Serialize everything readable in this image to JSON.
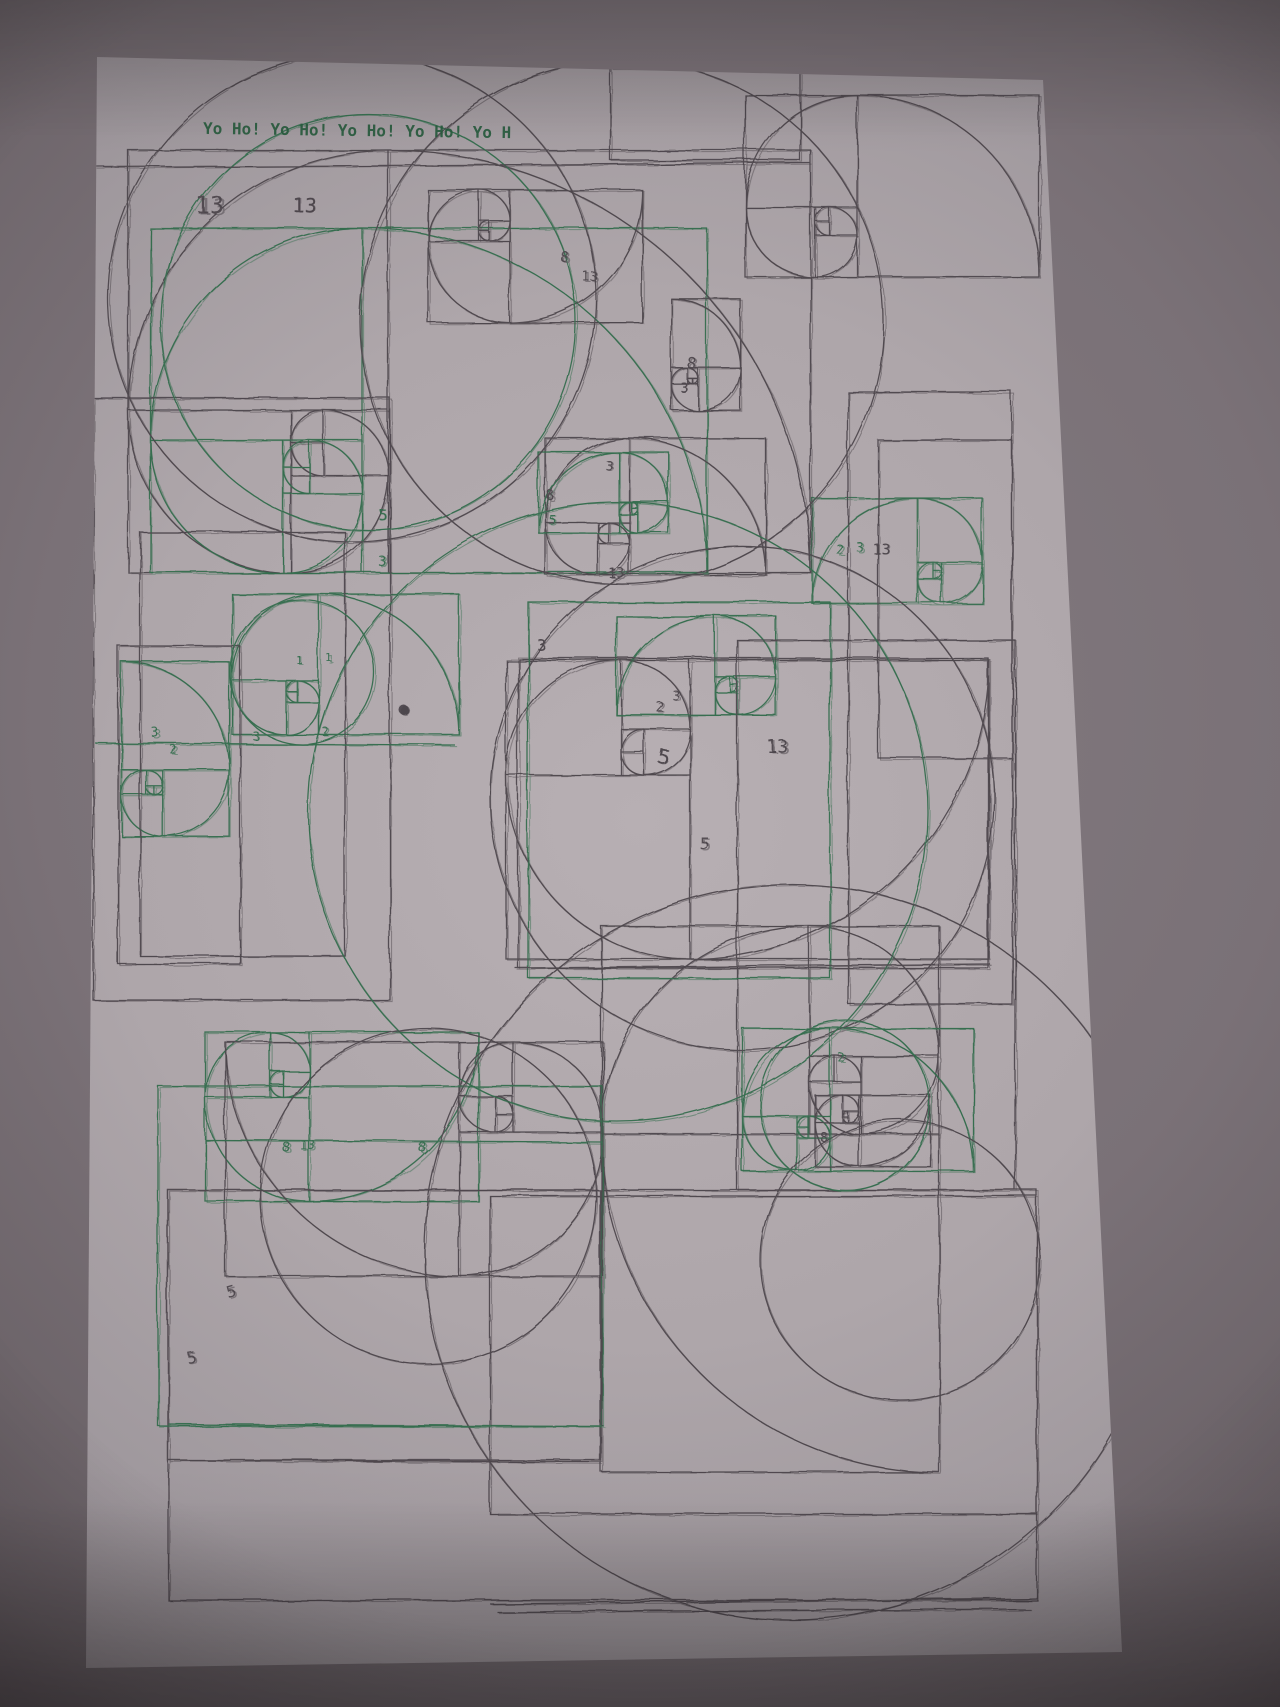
{
  "scene": {
    "description": "Photograph of a sheet of paper covered with many overlapping pen-plotter drawings of Fibonacci golden-rectangle constructions and quarter-circle spirals, drawn in dark grey and green ink, photographed in dim light with a strong vignette",
    "backdrop_color": "#6e666b",
    "vignette_color": "#1a1417",
    "paper_color": "#b4acb0",
    "paper_edge_color": "#8a838a"
  },
  "header": {
    "text": "Yo Ho! Yo Ho! Yo Ho! Yo Ho! Yo H",
    "color": "#26593c"
  },
  "inks": {
    "dark": "#4a4348",
    "green": "#2f6b4a"
  },
  "fibonacci_sequence_labels": [
    "1",
    "1",
    "2",
    "3",
    "5",
    "8",
    "13"
  ],
  "drawing": {
    "units": [
      {
        "x": 128,
        "y": 150,
        "s": 32.5,
        "rot": 0,
        "flip": true,
        "color": "dark"
      },
      {
        "x": 150,
        "y": 228,
        "s": 26.5,
        "rot": 0,
        "flip": true,
        "color": "green"
      },
      {
        "x": 428,
        "y": 190,
        "s": 10.2,
        "rot": 180,
        "flip": false,
        "color": "dark"
      },
      {
        "x": 745,
        "y": 95,
        "s": 14,
        "rot": 0,
        "flip": true,
        "color": "dark"
      },
      {
        "x": 545,
        "y": 438,
        "s": 10.5,
        "rot": 0,
        "flip": true,
        "color": "dark"
      },
      {
        "x": 538,
        "y": 452,
        "s": 6.2,
        "rot": 0,
        "flip": false,
        "color": "green"
      },
      {
        "x": 650,
        "y": 320,
        "s": 5.3,
        "rot": 90,
        "flip": false,
        "color": "dark"
      },
      {
        "x": 812,
        "y": 498,
        "s": 8.1,
        "rot": 0,
        "flip": false,
        "color": "green"
      },
      {
        "x": 506,
        "y": 660,
        "s": 23,
        "rot": 180,
        "flip": false,
        "color": "dark"
      },
      {
        "x": 616,
        "y": 616,
        "s": 7.6,
        "rot": 0,
        "flip": false,
        "color": "green"
      },
      {
        "x": 232,
        "y": 594,
        "s": 10.8,
        "rot": 0,
        "flip": true,
        "color": "green"
      },
      {
        "x": 88,
        "y": 695,
        "s": 8.3,
        "rot": 90,
        "flip": false,
        "color": "green"
      },
      {
        "x": 205,
        "y": 1032,
        "s": 13,
        "rot": 180,
        "flip": false,
        "color": "green"
      },
      {
        "x": 225,
        "y": 1042,
        "s": 18,
        "rot": 180,
        "flip": true,
        "color": "dark"
      },
      {
        "x": 497,
        "y": 1030,
        "s": 26,
        "rot": 270,
        "flip": false,
        "color": "dark"
      },
      {
        "x": 742,
        "y": 1028,
        "s": 11,
        "rot": 0,
        "flip": true,
        "color": "green"
      },
      {
        "x": 815,
        "y": 1095,
        "s": 5.5,
        "rot": 180,
        "flip": false,
        "color": "dark"
      }
    ],
    "rects": [
      {
        "x": 93,
        "y": 398,
        "w": 297,
        "h": 602,
        "c": "dark"
      },
      {
        "x": 140,
        "y": 532,
        "w": 205,
        "h": 424,
        "c": "dark"
      },
      {
        "x": 118,
        "y": 646,
        "w": 122,
        "h": 318,
        "c": "dark"
      },
      {
        "x": 848,
        "y": 392,
        "w": 164,
        "h": 612,
        "c": "dark"
      },
      {
        "x": 878,
        "y": 440,
        "w": 134,
        "h": 318,
        "c": "dark"
      },
      {
        "x": 737,
        "y": 640,
        "w": 278,
        "h": 550,
        "c": "dark"
      },
      {
        "x": 518,
        "y": 658,
        "w": 470,
        "h": 310,
        "c": "dark"
      },
      {
        "x": 610,
        "y": 68,
        "w": 190,
        "h": 92,
        "c": "dark"
      },
      {
        "x": 168,
        "y": 1190,
        "w": 432,
        "h": 270,
        "c": "dark"
      },
      {
        "x": 490,
        "y": 1196,
        "w": 547,
        "h": 318,
        "c": "dark"
      },
      {
        "x": 168,
        "y": 1190,
        "w": 869,
        "h": 410,
        "c": "dark"
      },
      {
        "x": 528,
        "y": 602,
        "w": 302,
        "h": 376,
        "c": "green"
      },
      {
        "x": 158,
        "y": 1086,
        "w": 444,
        "h": 340,
        "c": "green"
      }
    ],
    "circles": [
      {
        "x": 352,
        "y": 298,
        "r": 244,
        "c": "dark"
      },
      {
        "x": 368,
        "y": 322,
        "r": 208,
        "c": "green"
      },
      {
        "x": 622,
        "y": 322,
        "r": 262,
        "c": "dark"
      },
      {
        "x": 742,
        "y": 798,
        "r": 252,
        "c": "dark"
      },
      {
        "x": 618,
        "y": 812,
        "r": 310,
        "c": "green"
      },
      {
        "x": 302,
        "y": 672,
        "r": 72,
        "c": "green"
      },
      {
        "x": 792,
        "y": 1252,
        "r": 368,
        "c": "dark"
      },
      {
        "x": 900,
        "y": 1260,
        "r": 140,
        "c": "dark"
      },
      {
        "x": 428,
        "y": 1196,
        "r": 168,
        "c": "dark"
      },
      {
        "x": 845,
        "y": 1105,
        "r": 85,
        "c": "green"
      }
    ],
    "lines": [
      {
        "x1": 95,
        "y1": 167,
        "x2": 810,
        "y2": 163,
        "c": "dark"
      },
      {
        "x1": 515,
        "y1": 968,
        "x2": 990,
        "y2": 964,
        "c": "dark"
      },
      {
        "x1": 95,
        "y1": 743,
        "x2": 455,
        "y2": 745,
        "c": "green"
      },
      {
        "x1": 205,
        "y1": 1140,
        "x2": 603,
        "y2": 1142,
        "c": "green"
      },
      {
        "x1": 168,
        "y1": 1424,
        "x2": 604,
        "y2": 1426,
        "c": "green"
      },
      {
        "x1": 168,
        "y1": 1460,
        "x2": 600,
        "y2": 1462,
        "c": "dark"
      },
      {
        "x1": 490,
        "y1": 1604,
        "x2": 1037,
        "y2": 1598,
        "c": "dark"
      },
      {
        "x1": 497,
        "y1": 1612,
        "x2": 1030,
        "y2": 1609,
        "c": "dark"
      }
    ],
    "labels": [
      {
        "t": "13",
        "x": 196,
        "y": 214,
        "c": "dark",
        "fs": 24,
        "r": 0
      },
      {
        "t": "13",
        "x": 292,
        "y": 212,
        "c": "dark",
        "fs": 20,
        "r": 0
      },
      {
        "t": "8",
        "x": 560,
        "y": 262,
        "c": "dark",
        "fs": 15,
        "r": 0
      },
      {
        "t": "13",
        "x": 582,
        "y": 281,
        "c": "dark",
        "fs": 13,
        "r": 0
      },
      {
        "t": "8",
        "x": 686,
        "y": 368,
        "c": "dark",
        "fs": 16,
        "r": 8
      },
      {
        "t": "3",
        "x": 680,
        "y": 392,
        "c": "dark",
        "fs": 13,
        "r": 0
      },
      {
        "t": "5",
        "x": 378,
        "y": 520,
        "c": "green",
        "fs": 15,
        "r": 0
      },
      {
        "t": "3",
        "x": 378,
        "y": 566,
        "c": "green",
        "fs": 14,
        "r": 0
      },
      {
        "t": "8",
        "x": 546,
        "y": 500,
        "c": "dark",
        "fs": 14,
        "r": 0
      },
      {
        "t": "5",
        "x": 548,
        "y": 524,
        "c": "green",
        "fs": 13,
        "r": 0
      },
      {
        "t": "3",
        "x": 605,
        "y": 470,
        "c": "dark",
        "fs": 13,
        "r": 0
      },
      {
        "t": "13",
        "x": 608,
        "y": 578,
        "c": "dark",
        "fs": 14,
        "r": 0
      },
      {
        "t": "3",
        "x": 536,
        "y": 650,
        "c": "dark",
        "fs": 16,
        "r": 0
      },
      {
        "t": "2",
        "x": 836,
        "y": 554,
        "c": "green",
        "fs": 13,
        "r": 0
      },
      {
        "t": "3",
        "x": 856,
        "y": 552,
        "c": "green",
        "fs": 13,
        "r": 0
      },
      {
        "t": "13",
        "x": 872,
        "y": 554,
        "c": "dark",
        "fs": 15,
        "r": 0
      },
      {
        "t": "2",
        "x": 656,
        "y": 712,
        "c": "dark",
        "fs": 14,
        "r": 0
      },
      {
        "t": "3",
        "x": 672,
        "y": 700,
        "c": "dark",
        "fs": 13,
        "r": 0
      },
      {
        "t": "5",
        "x": 656,
        "y": 762,
        "c": "dark",
        "fs": 20,
        "r": 10
      },
      {
        "t": "13",
        "x": 766,
        "y": 752,
        "c": "dark",
        "fs": 18,
        "r": 0
      },
      {
        "t": "5",
        "x": 700,
        "y": 850,
        "c": "dark",
        "fs": 17,
        "r": 0
      },
      {
        "t": "1",
        "x": 296,
        "y": 664,
        "c": "green",
        "fs": 11,
        "r": 0
      },
      {
        "t": "1",
        "x": 326,
        "y": 662,
        "c": "green",
        "fs": 11,
        "r": 0
      },
      {
        "t": "2",
        "x": 322,
        "y": 736,
        "c": "green",
        "fs": 12,
        "r": 0
      },
      {
        "t": "3",
        "x": 252,
        "y": 740,
        "c": "green",
        "fs": 12,
        "r": 0
      },
      {
        "t": "3",
        "x": 152,
        "y": 738,
        "c": "green",
        "fs": 13,
        "r": 0
      },
      {
        "t": "2",
        "x": 170,
        "y": 754,
        "c": "green",
        "fs": 12,
        "r": 0
      },
      {
        "t": "8",
        "x": 282,
        "y": 1152,
        "c": "green",
        "fs": 14,
        "r": 0
      },
      {
        "t": "13",
        "x": 300,
        "y": 1150,
        "c": "green",
        "fs": 13,
        "r": 0
      },
      {
        "t": "8",
        "x": 418,
        "y": 1152,
        "c": "green",
        "fs": 14,
        "r": 0
      },
      {
        "t": "5",
        "x": 228,
        "y": 1298,
        "c": "dark",
        "fs": 16,
        "r": -15
      },
      {
        "t": "5",
        "x": 188,
        "y": 1364,
        "c": "dark",
        "fs": 16,
        "r": -10
      },
      {
        "t": "2",
        "x": 838,
        "y": 1062,
        "c": "green",
        "fs": 12,
        "r": 0
      },
      {
        "t": "8",
        "x": 820,
        "y": 1142,
        "c": "dark",
        "fs": 13,
        "r": 0
      }
    ],
    "dot": {
      "x": 404,
      "y": 710,
      "r": 5
    }
  }
}
